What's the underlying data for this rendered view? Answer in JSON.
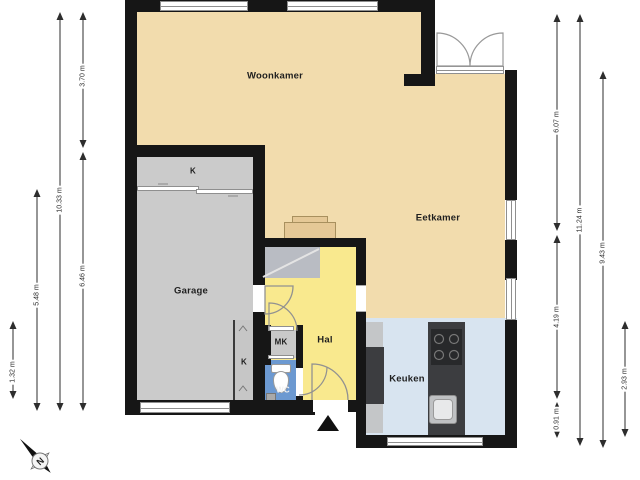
{
  "rooms": {
    "woonkamer": "Woonkamer",
    "eetkamer": "Eetkamer",
    "garage": "Garage",
    "hal": "Hal",
    "keuken": "Keuken",
    "wc": "WC",
    "mk": "MK",
    "closet_top": "K",
    "closet_small": "K"
  },
  "dimensions": {
    "left_closet": "1.32 m",
    "left_garage": "5.48 m",
    "left_total": "10.33 m",
    "left_top": "3.70 m",
    "left_bottom": "6.46 m",
    "right_top": "6.07 m",
    "right_middle": "4.19 m",
    "right_entry": "0.91 m",
    "right_total": "11.24 m",
    "right_inner": "9.43 m",
    "right_kitchen": "2.93 m"
  },
  "compass": {
    "north": "N"
  },
  "colors": {
    "wall": "#161616",
    "living_floor": "#F2DCAD",
    "hall_floor": "#F9E98E",
    "garage_floor": "#CBCBCB",
    "kitchen_floor": "#D8E4F0",
    "wc_floor": "#6C99D1",
    "counter_dark": "#3C3D40",
    "counter_light": "#C4C6C8",
    "stairs": "#B9BCC3",
    "cabinet": "#E5C896"
  }
}
